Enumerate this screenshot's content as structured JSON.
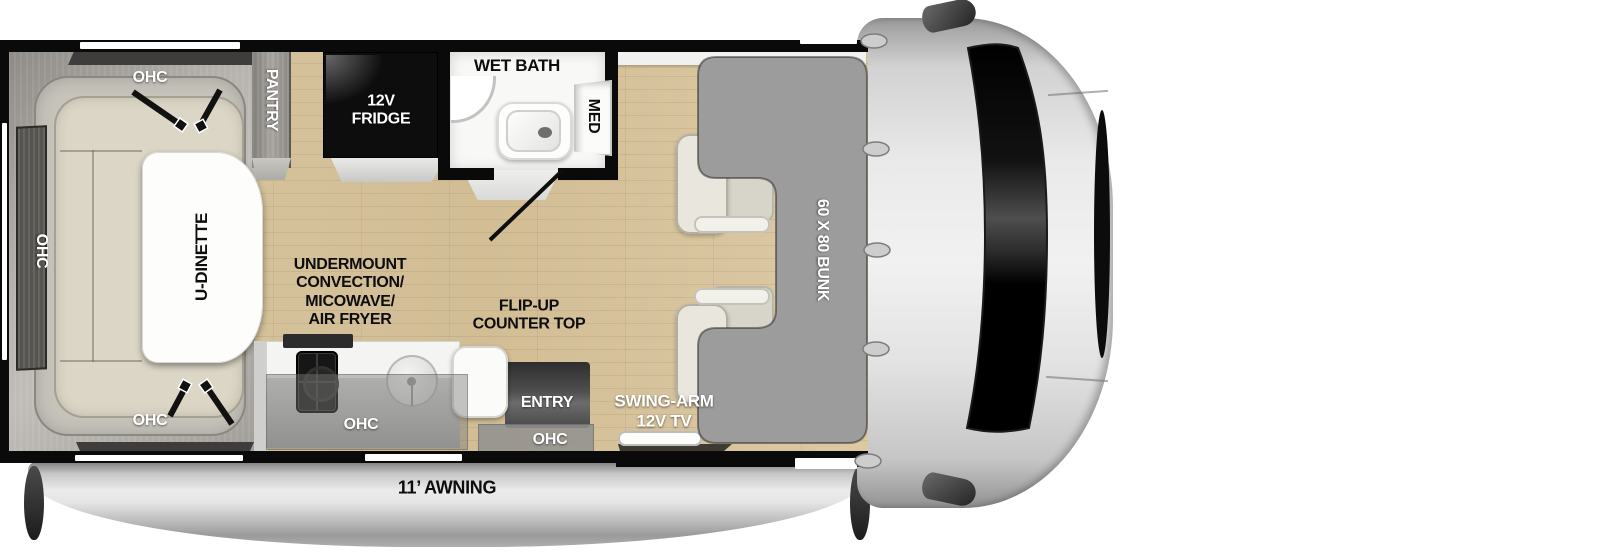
{
  "title": "RV floor plan - 60x80 bunk travel motorhome layout",
  "labels": {
    "ohc": "OHC",
    "pantry": "PANTRY",
    "fridge_line1": "12V",
    "fridge_line2": "FRIDGE",
    "wet_bath": "WET BATH",
    "med": "MED",
    "u_dinette": "U-DINETTE",
    "appliance_line1": "UNDERMOUNT",
    "appliance_line2": "CONVECTION/",
    "appliance_line3": "MICOWAVE/",
    "appliance_line4": "AIR FRYER",
    "flip_line1": "FLIP-UP",
    "flip_line2": "COUNTER TOP",
    "entry": "ENTRY",
    "tv_line1": "SWING-ARM",
    "tv_line2": "12V TV",
    "bunk": "60 X 80 BUNK",
    "awning": "11’ AWNING"
  },
  "colors": {
    "wall": "#0a0a0a",
    "floor-wood": "#d5c29c",
    "bunk-gray": "#9c9c9c",
    "cushion-cream": "#dcd6c6",
    "cab-gray": "#e9e9e9",
    "awning-silver": "#c7c7c7",
    "label-white": "#ffffff",
    "label-black": "#0d0d0d"
  }
}
